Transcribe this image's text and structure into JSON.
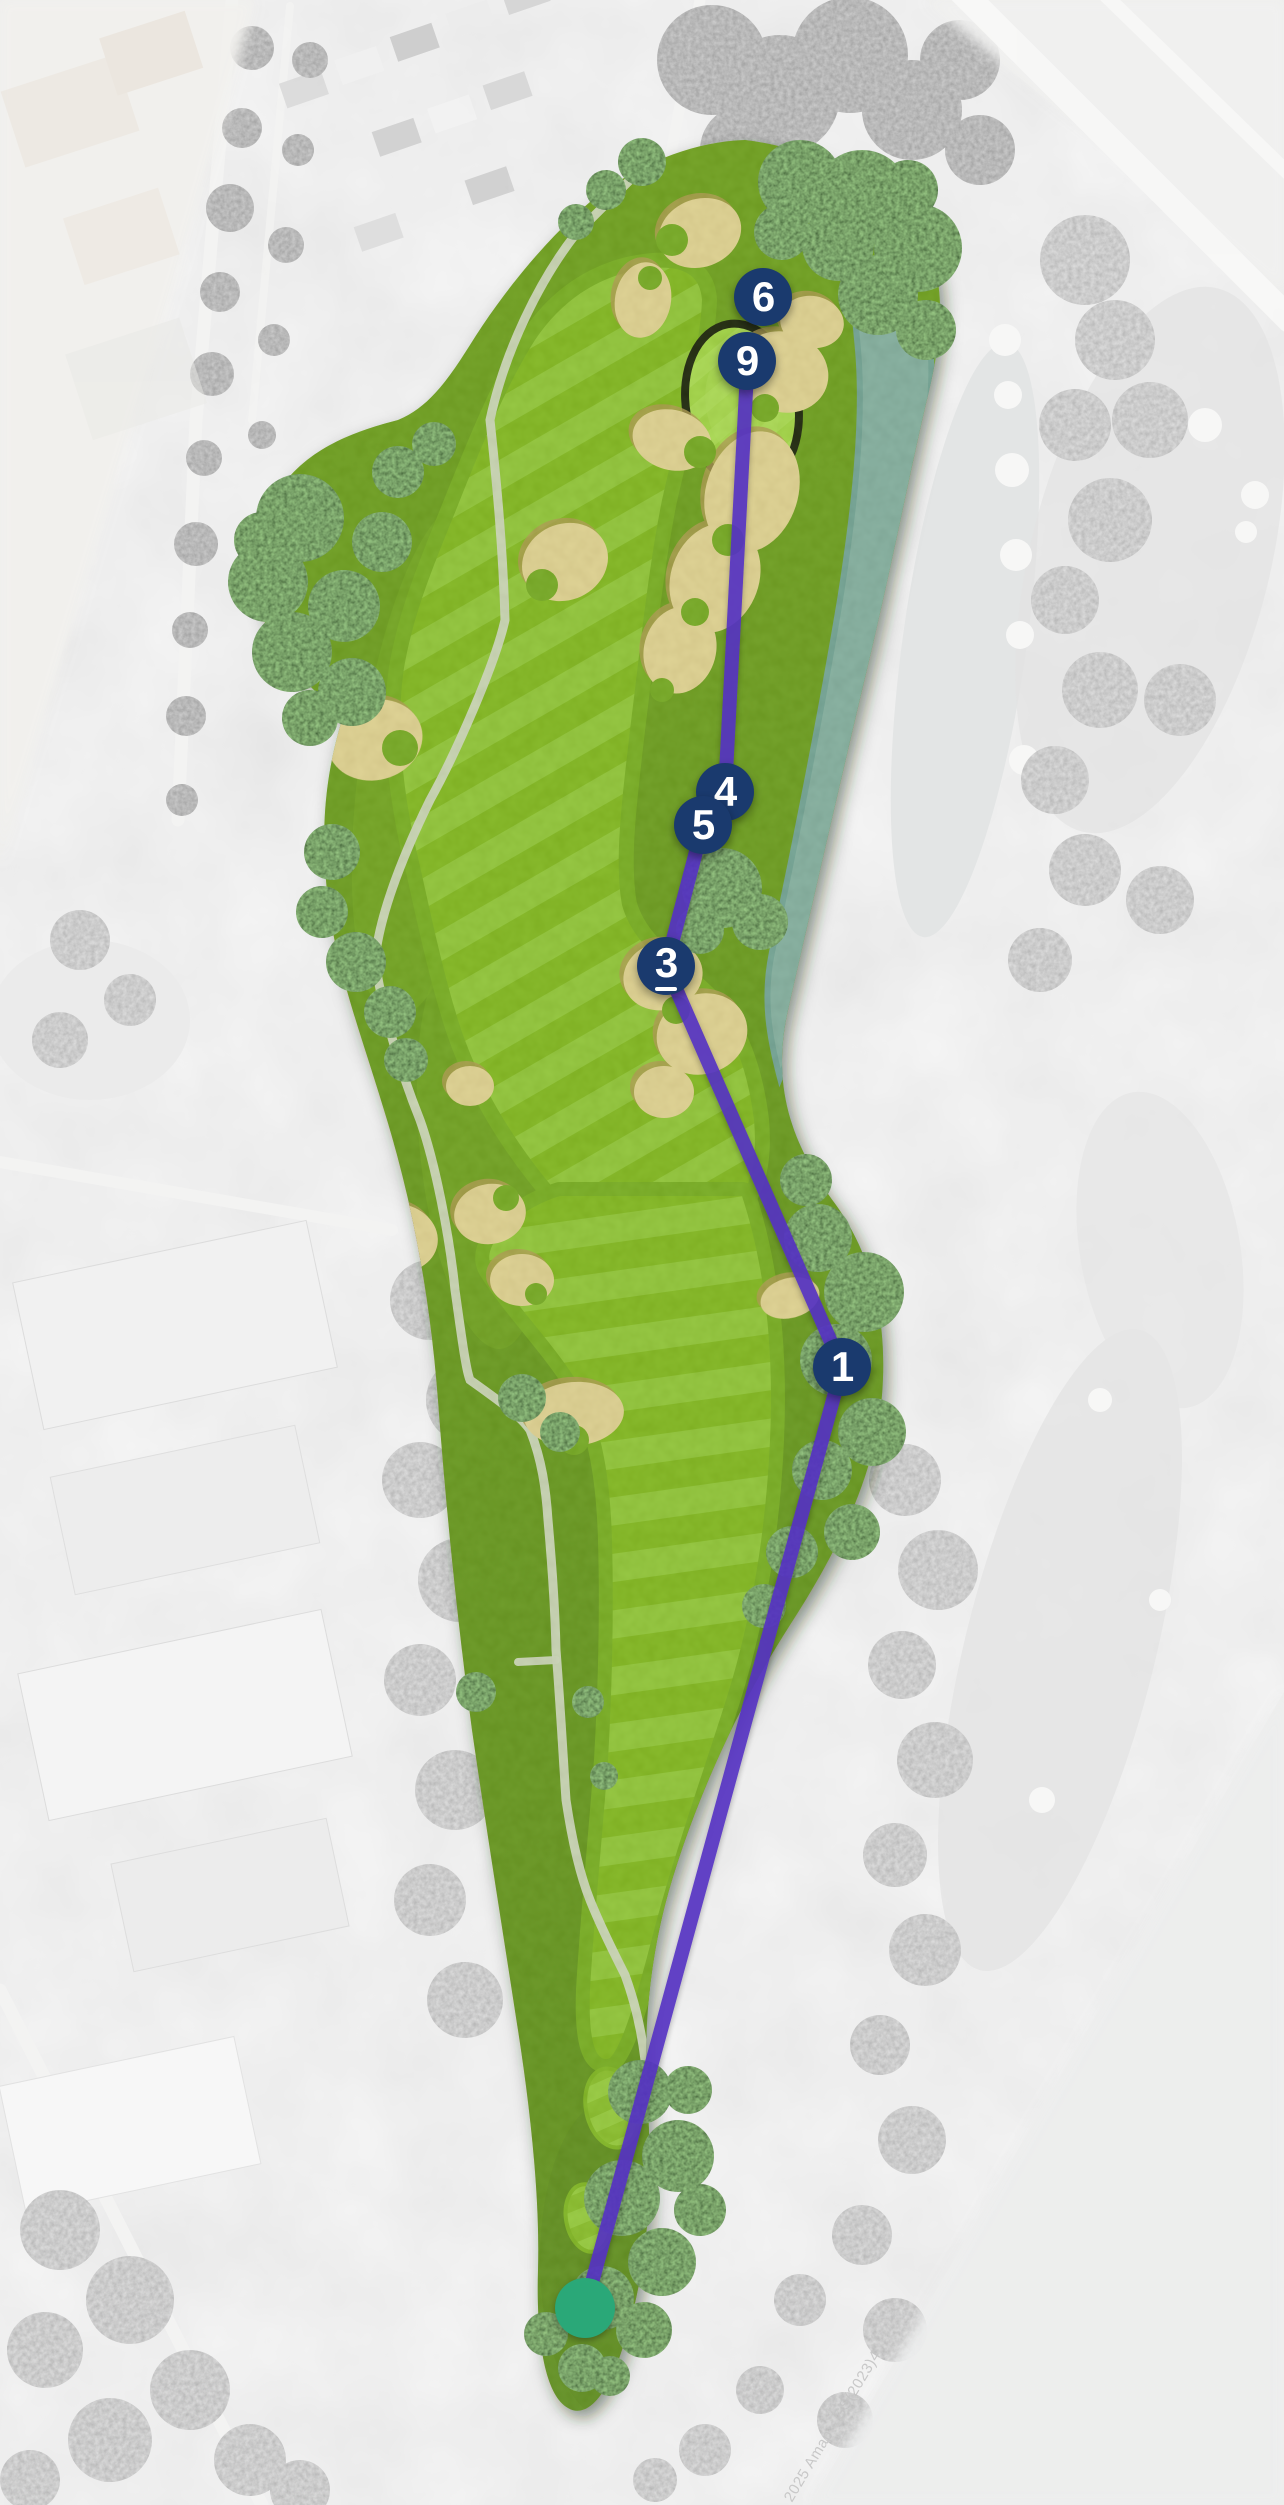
{
  "map": {
    "description": "golf-hole-satellite-overlay",
    "watermark": "2025 Amap - GS(2023)4",
    "tee": {
      "x": 585,
      "y": 2308
    },
    "route": {
      "color": "#5431c2",
      "points": [
        [
          585,
          2308
        ],
        [
          842,
          1367
        ],
        [
          666,
          966
        ],
        [
          703,
          825
        ],
        [
          725,
          792
        ],
        [
          747,
          372
        ]
      ]
    },
    "markers": {
      "fill": "#1a3a6e",
      "text_color": "#ffffff",
      "items": [
        {
          "label": "1",
          "x": 842,
          "y": 1367,
          "underlined": false
        },
        {
          "label": "3",
          "x": 666,
          "y": 966,
          "underlined": true
        },
        {
          "label": "4",
          "x": 725,
          "y": 792,
          "underlined": false
        },
        {
          "label": "5",
          "x": 703,
          "y": 825,
          "underlined": false
        },
        {
          "label": "6",
          "x": 763,
          "y": 297,
          "underlined": false
        },
        {
          "label": "9",
          "x": 747,
          "y": 361,
          "underlined": false
        }
      ]
    },
    "colors": {
      "background": "#ededec",
      "tee": "#2aa878",
      "water": "#7ca6b3",
      "water_edge": "#6797a6",
      "sand": "#ecd0a2",
      "sand_shadow": "#b08e52",
      "fairway_light": "#8cc236",
      "fairway_dark": "#7ab117",
      "semi_rough": "#6ea51a",
      "rough": "#5f9118",
      "green": "#a3d647",
      "green_fringe": "#8dbd37",
      "cart_path": "#d6d6d5"
    }
  }
}
